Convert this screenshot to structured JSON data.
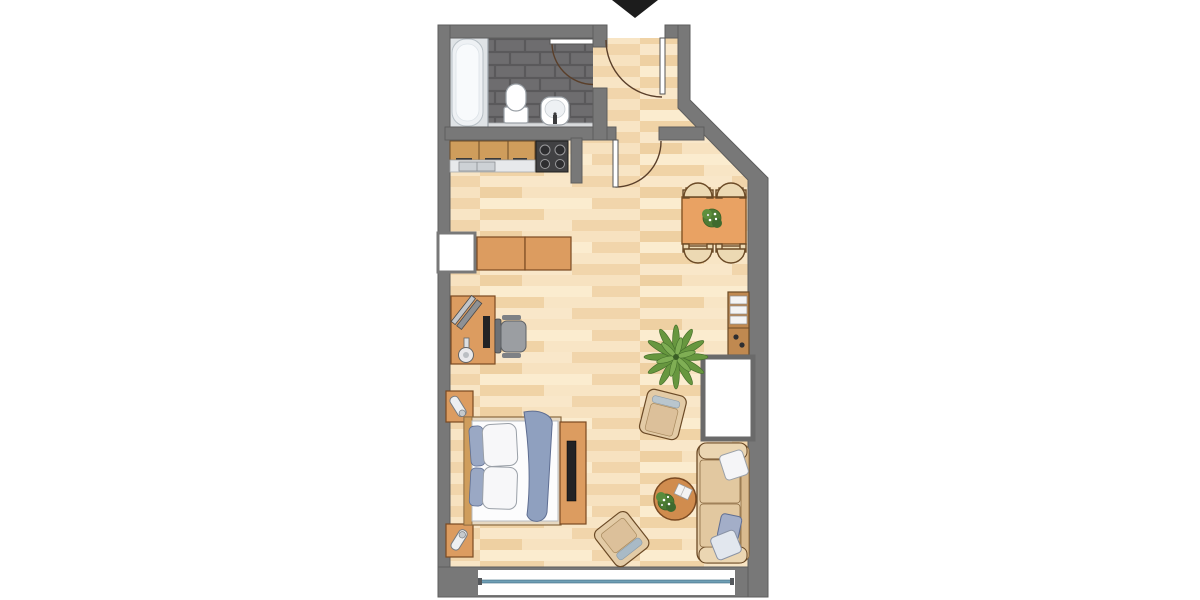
{
  "scene": {
    "type": "apartment-floor-plan",
    "description": "Top-down studio apartment floor plan with entrance arrow at top, bathroom and kitchen upper left, entry hall upper right with angled exterior wall, open living area with dining set, desk, bed, sofa, armchairs and balcony window at bottom",
    "entrance": {
      "marker": "black-down-arrow",
      "location": "top-center"
    }
  },
  "rooms": [
    {
      "name": "bathroom",
      "floor": "dark-gray-tile",
      "fixtures": [
        "bathtub",
        "toilet",
        "sink",
        "vanity-counter",
        "swing-door"
      ]
    },
    {
      "name": "entry-hall",
      "floor": "wood",
      "fixtures": [
        "entry-door",
        "interior-door"
      ]
    },
    {
      "name": "kitchen-nook",
      "floor": "wood",
      "fixtures": [
        "wood-cabinets-3",
        "double-sink-counter",
        "stove-4-burners"
      ]
    },
    {
      "name": "living-room",
      "floor": "wood",
      "fixtures": [
        "left-wall-window",
        "balcony-window"
      ]
    }
  ],
  "furniture": [
    "dining-table-with-plant",
    "dining-chairs-4",
    "sideboard-2-modules",
    "desk",
    "laptop",
    "desk-lamp",
    "monitor",
    "office-chair",
    "shelf-unit",
    "wardrobe",
    "potted-palm-plant",
    "armchair-upper",
    "armchair-lower",
    "round-coffee-table-with-plant-and-book",
    "sofa-with-3-pillows",
    "bed-double",
    "pillows-blue-white",
    "blanket-blue",
    "nightstand-top",
    "nightstand-bottom",
    "bedside-lamps-2",
    "media-cabinet-with-tv"
  ],
  "colors": {
    "background": "#ffffff",
    "wall": "#787878",
    "wall_edge": "#5e5e5e",
    "floor_base": "#f5dfba",
    "plank_light": "#f9e7c9",
    "plank_cream": "#fbeccf",
    "plank_tan": "#f1d5ab",
    "plank_deep": "#eed0a2",
    "bathroom_tile": "#6e6d6f",
    "tile_grout": "#5a595b",
    "fixture_white": "#ffffff",
    "fixture_outline": "#9aa0a6",
    "vanity_gray": "#d9dbdd",
    "cabinet_wood": "#cf9d5c",
    "wood_outline": "#6b4a26",
    "counter_gray": "#e7e9eb",
    "stove_black": "#414143",
    "furniture_tan": "#dc9c60",
    "furniture_outline": "#7a4a22",
    "table_orange": "#e9a263",
    "chair_cream": "#ecd9b3",
    "sofa_tan": "#e5cda8",
    "pillow_white": "#f5f5f7",
    "pillow_blue": "#a3aec8",
    "blanket_blue": "#8fa0bf",
    "plant_green": "#67973f",
    "plant_dark": "#46702c",
    "office_gray": "#9b9ea2",
    "window_blue": "#6f9fb5",
    "tv_black": "#232325",
    "entrance_arrow": "#1c1c1c"
  }
}
